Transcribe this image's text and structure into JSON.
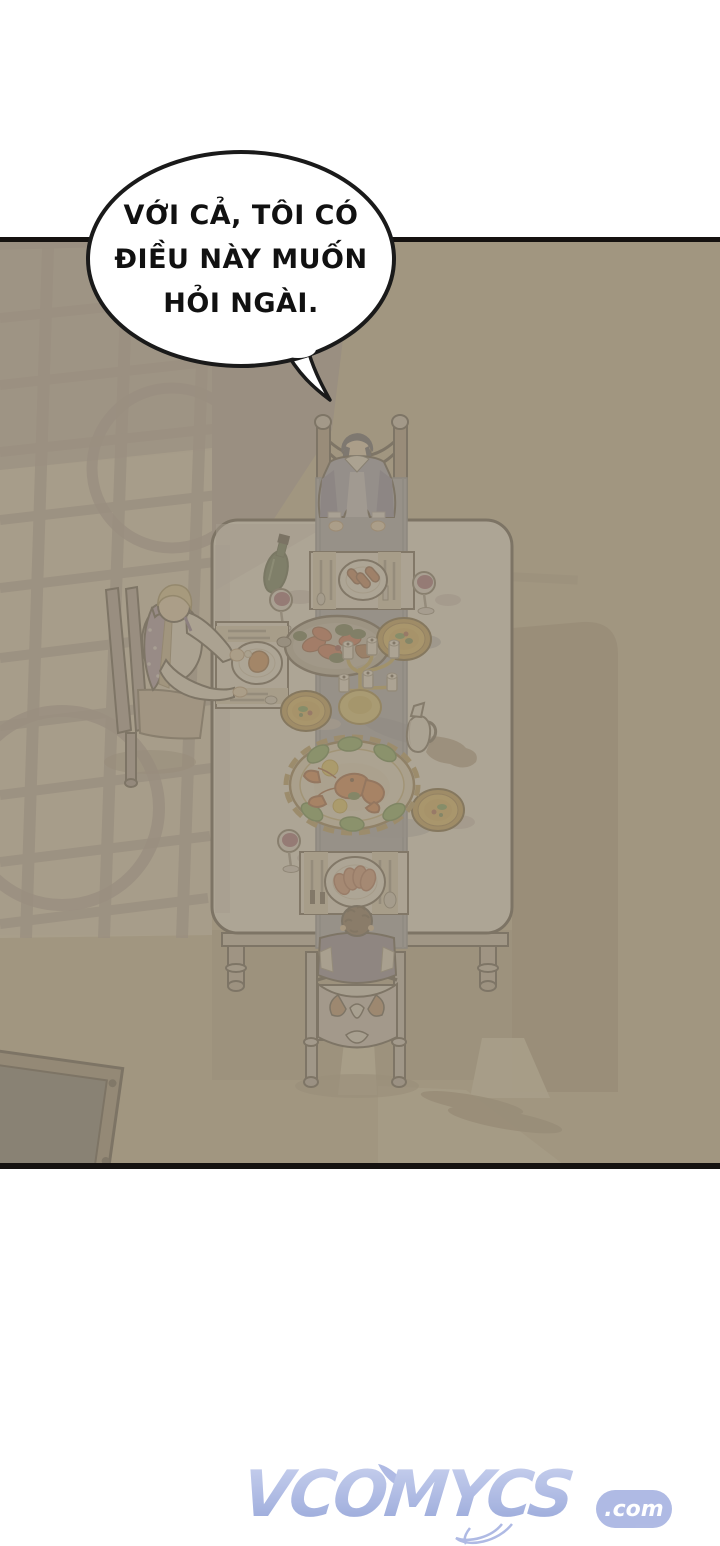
{
  "page": {
    "type": "webtoon-comic-panel",
    "width": 720,
    "height": 1546
  },
  "speech_bubble": {
    "lines": [
      "VỚI CẢ, TÔI CÓ",
      "ĐIỀU NÀY MUỐN",
      "HỎI NGÀI."
    ]
  },
  "watermark": {
    "name": "VCOMYCS",
    "suffix": ".com"
  },
  "scene": {
    "setting": "Top-down view of a dining room with a long white table, window light on the floor",
    "characters": [
      "woman in blue gown seated at head of table",
      "blond man in purple dotted vest seated at left side",
      "brown-haired man in purple coat seated at foot of table"
    ],
    "objects": [
      "long white dining table",
      "blue-gray table runner",
      "three place settings with meat plates",
      "roast drumstick plate",
      "silver seafood platter",
      "ornate lobster platter",
      "three golden soup plates",
      "gold candelabra with white candles",
      "green wine bottle",
      "three glasses of red wine",
      "white pitcher",
      "window-frame light pattern",
      "cast table shadow",
      "dark side table"
    ]
  },
  "palette": {
    "floor_beige": "#c7ba9c",
    "floor_mauve": "#a79a9d",
    "window_light": "#e9e0c9",
    "table_shadow": "#a59377",
    "table_white": "#fcfbf7",
    "runner_blue": "#98a3c0",
    "wine_purple": "#8e3f68",
    "gold": "#e9ba41",
    "lobster_orange": "#e2611f",
    "watermark_blue": "#a9b5e2",
    "ink": "#1a1a1a"
  }
}
